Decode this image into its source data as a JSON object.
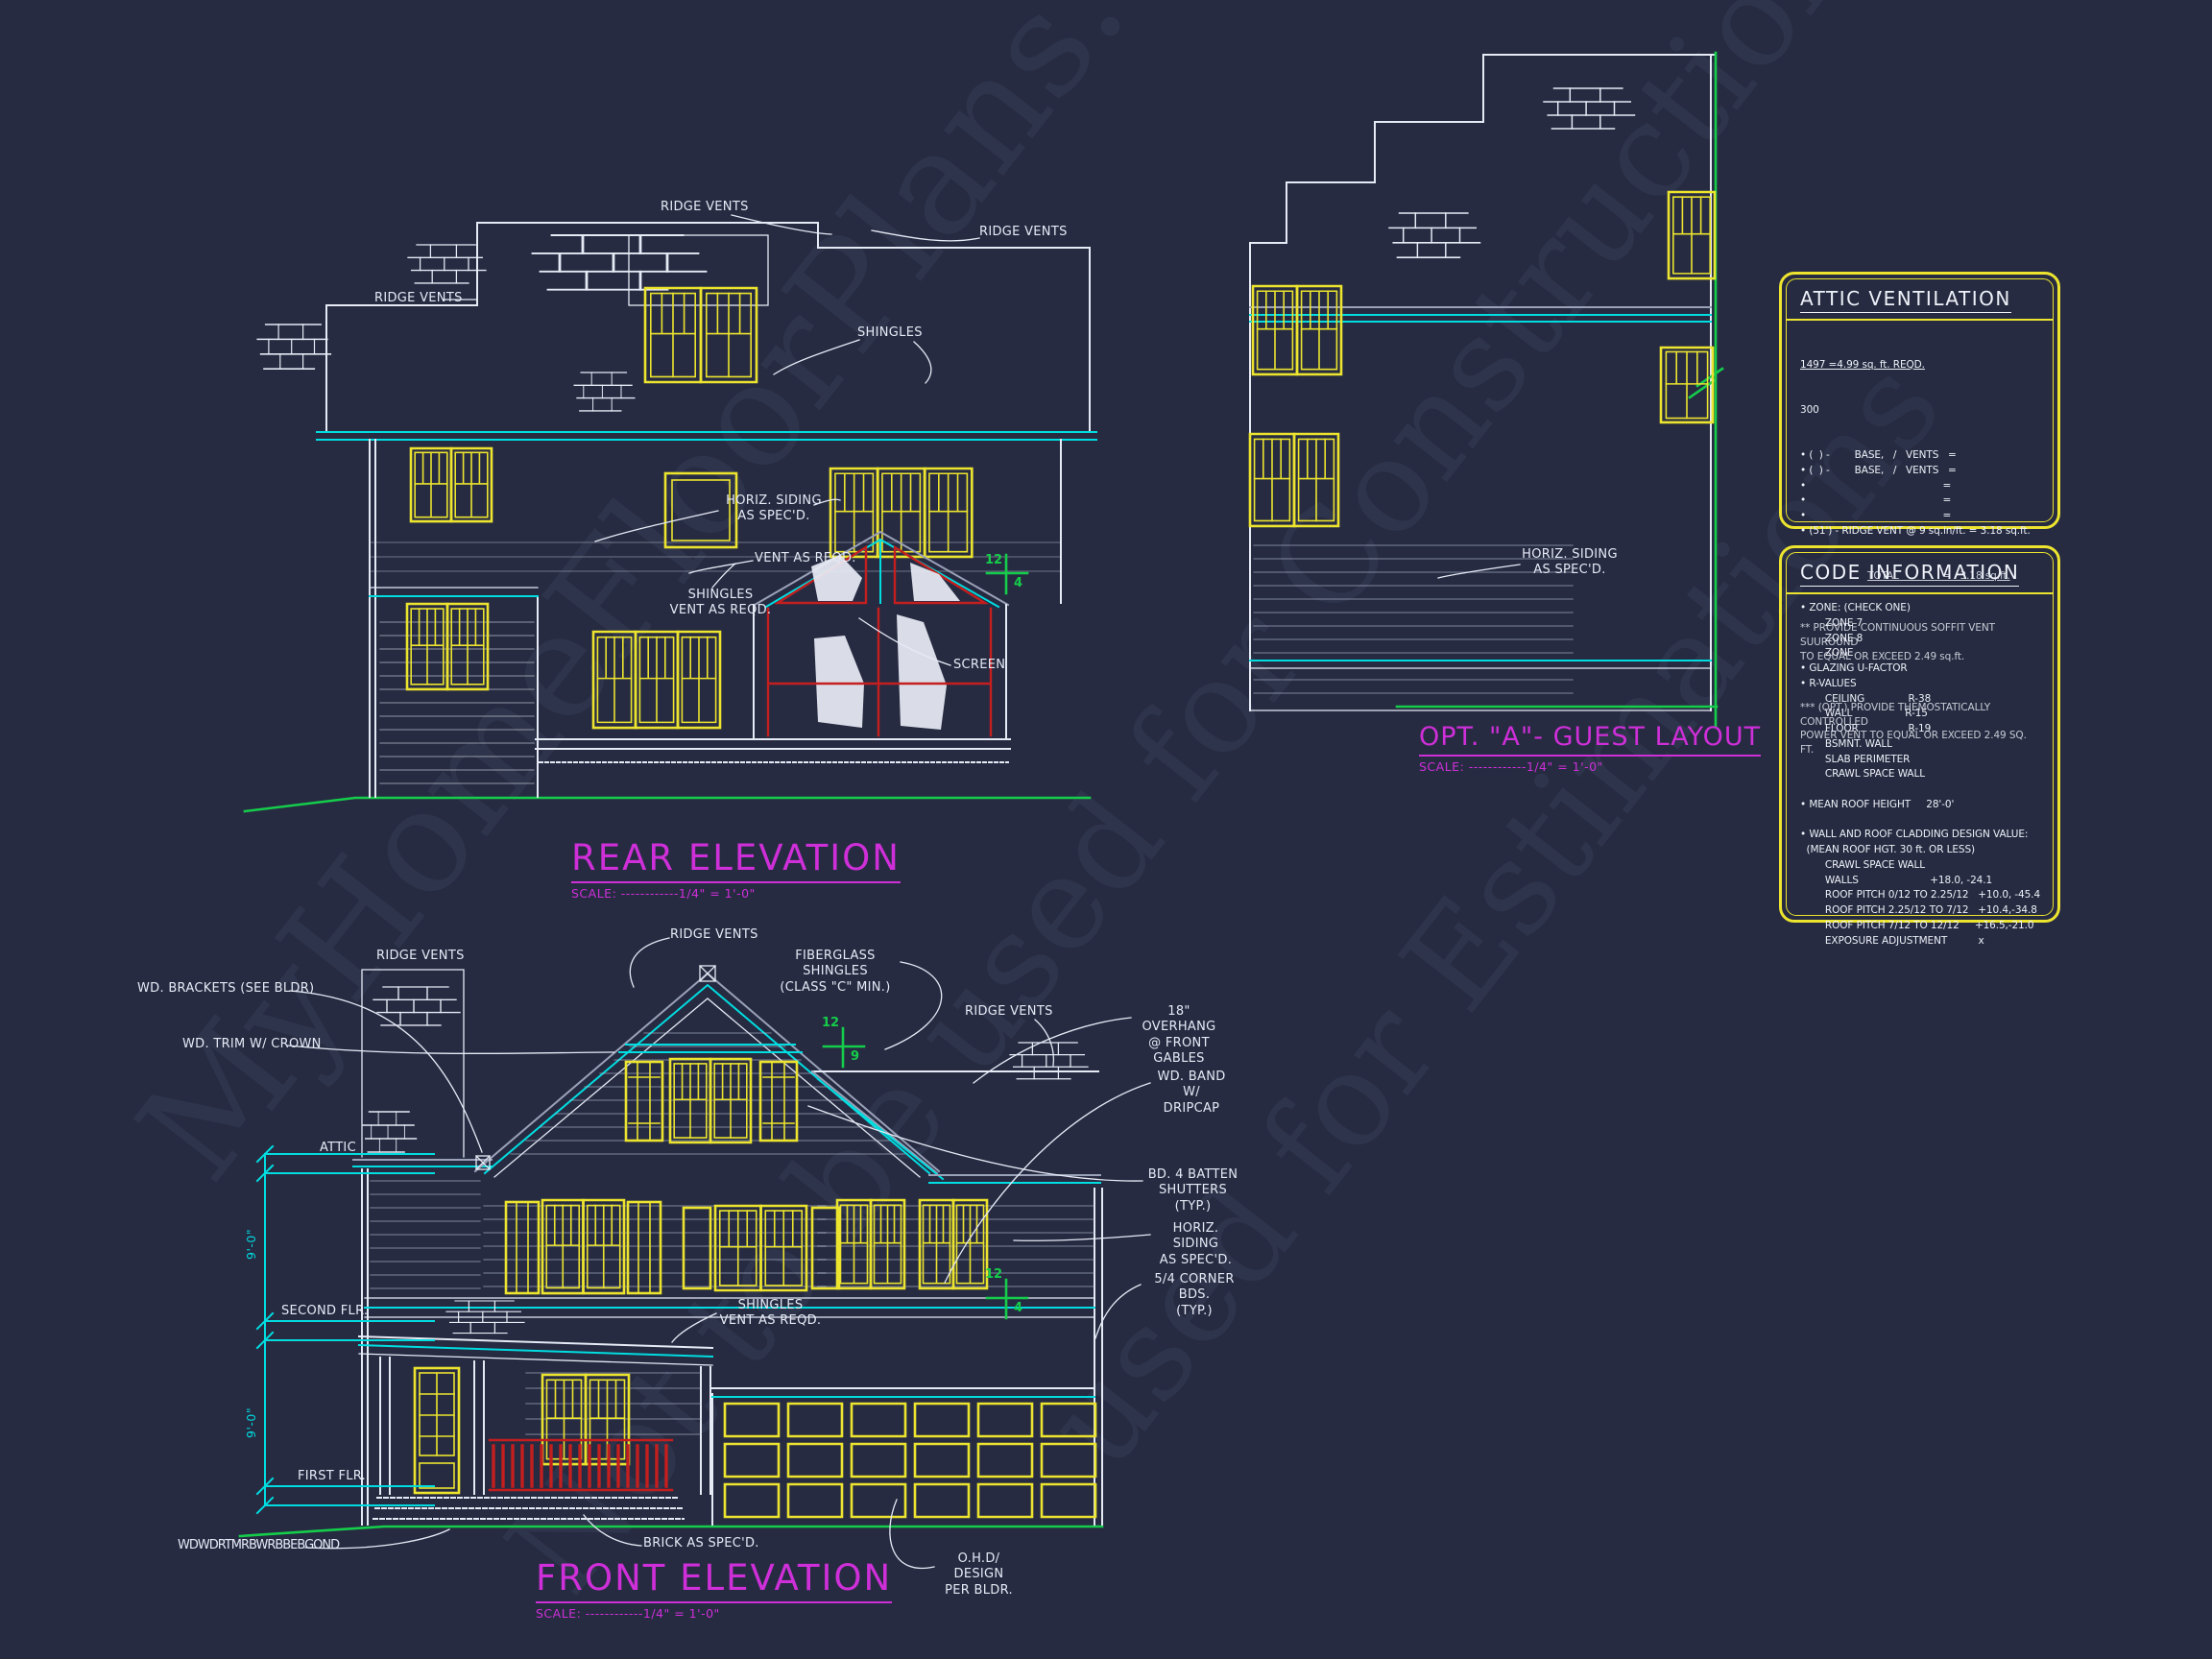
{
  "sheet": {
    "background": "#262b42",
    "watermarks": [
      "MyHomeFloorPlans.com",
      "Not to be used for Construction",
      "used for Estimations"
    ]
  },
  "colors": {
    "line_white": "#e6eaf5",
    "trim_cyan": "#00dde0",
    "window_yellow": "#ece42e",
    "title_magenta": "#cf2fd8",
    "grade_green": "#15cd4a",
    "accent_red": "#c41e1e",
    "roof_gray": "#9aa2b8"
  },
  "rear_elevation": {
    "title": "REAR ELEVATION",
    "scale": "SCALE: ------------1/4\" = 1'-0\"",
    "labels": {
      "ridge_vents": "RIDGE VENTS",
      "shingles": "SHINGLES",
      "horiz_siding": "HORIZ. SIDING\nAS SPEC'D.",
      "vent_as_reqd": "VENT AS REQD.",
      "shingles_vent": "SHINGLES\nVENT AS REQD.",
      "screen": "SCREEN"
    },
    "roof_pitch": {
      "rise": "12",
      "run": "4"
    }
  },
  "front_elevation": {
    "title": "FRONT ELEVATION",
    "scale": "SCALE: ------------1/4\" = 1'-0\"",
    "labels": {
      "wd_brackets": "WD. BRACKETS (SEE BLDR)",
      "wd_trim": "WD. TRIM W/ CROWN",
      "attic": "ATTIC",
      "second_flr": "SECOND FLR.",
      "first_flr": "FIRST FLR.",
      "ridge_vents": "RIDGE VENTS",
      "fiberglass": "FIBERGLASS SHINGLES\n(CLASS \"C\" MIN.)",
      "overhang": "18\" OVERHANG\n@ FRONT GABLES",
      "wd_band": "WD. BAND W/\nDRIPCAP",
      "shutters": "BD. 4 BATTEN\nSHUTTERS (TYP.)",
      "horiz_siding": "HORIZ. SIDING\nAS SPEC'D.",
      "corner_bds": "5/4 CORNER BDS.\n(TYP.)",
      "shingles_vent": "SHINGLES\nVENT AS REQD.",
      "brick": "BRICK AS SPEC'D.",
      "ohd": "O.H.D/ DESIGN\nPER BLDR.",
      "grade_note": "WDWDRTMRBWRBBEBGOND"
    },
    "dimensions": {
      "attic_to_second": "9'-0\"",
      "second_to_first": "9'-0\""
    },
    "gable_pitch": {
      "rise": "12",
      "run": "9"
    },
    "right_pitch": {
      "rise": "12",
      "run": "4"
    }
  },
  "guest_layout": {
    "title": "OPT. \"A\"- GUEST LAYOUT",
    "scale": "SCALE: ------------1/4\" = 1'-0\"",
    "labels": {
      "horiz_siding": "HORIZ. SIDING\nAS SPEC'D."
    }
  },
  "attic_ventilation": {
    "title": "ATTIC VENTILATION",
    "calc_numerator": "1497 =4.99 sq. ft. REQD.",
    "calc_denominator": "300",
    "lines": [
      "• (  ) -        BASE,   /   VENTS   =",
      "• (  ) -        BASE,   /   VENTS   =",
      "•                                            =",
      "•                                            =",
      "•                                            =",
      "• (51') - RIDGE VENT @ 9 sq.in/ft. = 3.18 sq.ft."
    ],
    "total": "TOTAL              =   3.18 sq.ft.",
    "notes": [
      "** PROVIDE CONTINUOUS SOFFIT VENT SUUROUND\nTO EQUAL OR EXCEED 2.49 sq.ft.",
      "*** (OPT.) PROVIDE THEMOSTATICALLY CONTROLLED\nPOWER VENT TO EQUAL OR EXCEED 2.49 SQ. FT."
    ]
  },
  "code_information": {
    "title": "CODE INFORMATION",
    "lines": [
      "• ZONE: (CHECK ONE)",
      "        ZONE 7",
      "        ZONE 8",
      "        ZONE",
      "• GLAZING U-FACTOR",
      "• R-VALUES",
      "        CEILING              R-38",
      "        WALL                 R-15",
      "        FLOOR                R-19",
      "        BSMNT. WALL",
      "        SLAB PERIMETER",
      "        CRAWL SPACE WALL",
      " ",
      "• MEAN ROOF HEIGHT     28'-0'",
      " ",
      "• WALL AND ROOF CLADDING DESIGN VALUE:",
      "  (MEAN ROOF HGT. 30 ft. OR LESS)",
      "        CRAWL SPACE WALL",
      "        WALLS                       +18.0, -24.1",
      "        ROOF PITCH 0/12 TO 2.25/12   +10.0, -45.4",
      "        ROOF PITCH 2.25/12 TO 7/12   +10.4,-34.8",
      "        ROOF PITCH 7/12 TO 12/12     +16.5,-21.0",
      "        EXPOSURE ADJUSTMENT          x"
    ]
  }
}
